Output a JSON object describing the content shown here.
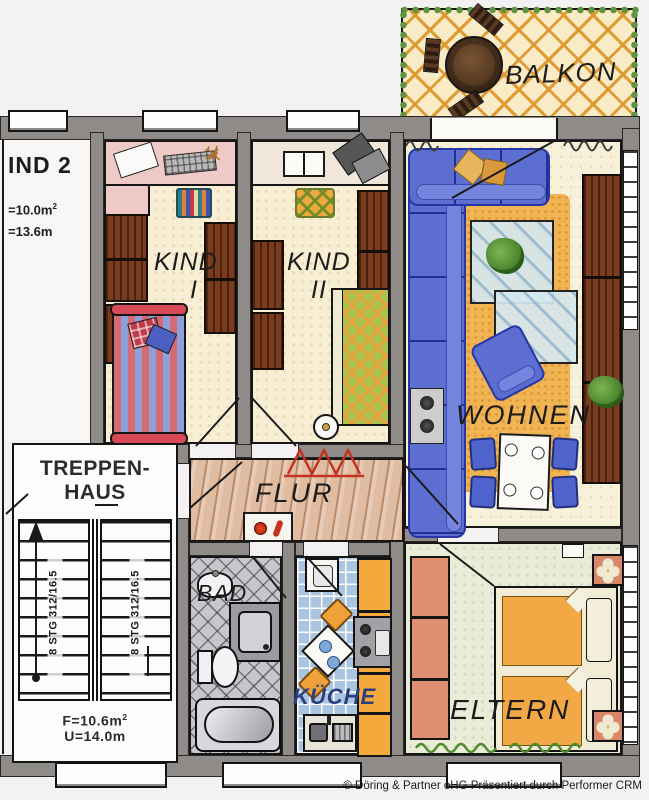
{
  "labels": {
    "balkon": "BALKON",
    "kind1_line1": "KIND",
    "kind1_line2": "I",
    "kind2_line1": "KIND",
    "kind2_line2": "II",
    "wohnen": "WOHNEN",
    "flur": "FLUR",
    "bad": "BAD",
    "kueche": "KÜCHE",
    "eltern": "ELTERN",
    "treppenhaus_line1": "TREPPEN-",
    "treppenhaus_line2": "HAUS"
  },
  "side_unit": {
    "name": "IND 2",
    "area": "=10.0m",
    "area_sup": "2",
    "length": "=13.6m"
  },
  "stairs": {
    "flight_label": "8 STG 312/16.5",
    "area": "F=10.6m",
    "area_sup": "2",
    "perimeter": "U=14.0m"
  },
  "footer": {
    "copyright": "© Döring & Partner oHG Präsentiert durch Performer CRM"
  },
  "colors": {
    "wall_gray": "#8f8b89",
    "sofa_blue": "#5c6fd0",
    "rug_orange": "#f1b452",
    "cabinet_orange": "#f3a93c",
    "wood_brown": "#7a3b1f",
    "tile_blue": "#a9c5e1",
    "tile_gray": "#c7c7cb",
    "floor_cream": "#f7eed3",
    "floor_green": "#e9edd8",
    "wardrobe_salmon": "#de8f72",
    "lattice_orange": "#de982c",
    "vine_green": "#5f9440",
    "bed_red": "#d84a57",
    "kueche_text_blue": "#2b3f7e"
  }
}
